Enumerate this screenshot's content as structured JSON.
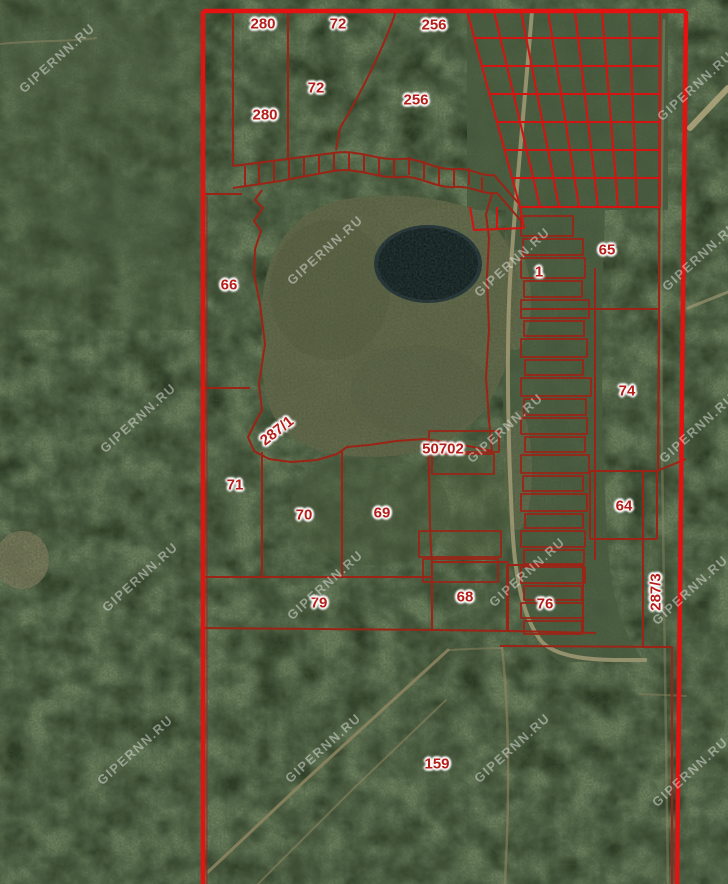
{
  "map": {
    "watermark_text": "GIPERNN.RU",
    "colors": {
      "outer_boundary": "#e41210",
      "grid_line": "#d51310",
      "parcel_line": "#9b2416",
      "label": "#b51d18",
      "watermark": "rgba(255,255,255,0.42)",
      "forest": "#26331f",
      "bog": "#6b6c4e",
      "lake": "#0c1522"
    },
    "parcel_labels": [
      {
        "text": "280",
        "x": 263,
        "y": 24,
        "rot": 0
      },
      {
        "text": "72",
        "x": 338,
        "y": 24,
        "rot": 0
      },
      {
        "text": "256",
        "x": 434,
        "y": 25,
        "rot": 0
      },
      {
        "text": "72",
        "x": 316,
        "y": 88,
        "rot": 0
      },
      {
        "text": "280",
        "x": 265,
        "y": 115,
        "rot": 0
      },
      {
        "text": "256",
        "x": 416,
        "y": 100,
        "rot": 0
      },
      {
        "text": "66",
        "x": 229,
        "y": 285,
        "rot": 0
      },
      {
        "text": "65",
        "x": 607,
        "y": 250,
        "rot": 0
      },
      {
        "text": "1",
        "x": 539,
        "y": 272,
        "rot": 0
      },
      {
        "text": "74",
        "x": 627,
        "y": 391,
        "rot": 0
      },
      {
        "text": "287/1",
        "x": 277,
        "y": 431,
        "rot": -38
      },
      {
        "text": "50702",
        "x": 443,
        "y": 449,
        "rot": 0
      },
      {
        "text": "71",
        "x": 235,
        "y": 485,
        "rot": 0
      },
      {
        "text": "70",
        "x": 304,
        "y": 515,
        "rot": 0
      },
      {
        "text": "69",
        "x": 382,
        "y": 513,
        "rot": 0
      },
      {
        "text": "64",
        "x": 624,
        "y": 506,
        "rot": 0
      },
      {
        "text": "79",
        "x": 319,
        "y": 603,
        "rot": 0
      },
      {
        "text": "68",
        "x": 465,
        "y": 597,
        "rot": 0
      },
      {
        "text": "76",
        "x": 545,
        "y": 604,
        "rot": 0
      },
      {
        "text": "287/3",
        "x": 656,
        "y": 592,
        "rot": -90
      },
      {
        "text": "159",
        "x": 437,
        "y": 764,
        "rot": 0
      }
    ],
    "watermarks": [
      {
        "x": 57,
        "y": 58
      },
      {
        "x": 695,
        "y": 86
      },
      {
        "x": 325,
        "y": 250
      },
      {
        "x": 512,
        "y": 262
      },
      {
        "x": 700,
        "y": 256
      },
      {
        "x": 138,
        "y": 418
      },
      {
        "x": 505,
        "y": 428
      },
      {
        "x": 697,
        "y": 428
      },
      {
        "x": 140,
        "y": 577
      },
      {
        "x": 325,
        "y": 585
      },
      {
        "x": 527,
        "y": 572
      },
      {
        "x": 690,
        "y": 590
      },
      {
        "x": 135,
        "y": 750
      },
      {
        "x": 323,
        "y": 748
      },
      {
        "x": 512,
        "y": 748
      },
      {
        "x": 690,
        "y": 772
      }
    ]
  }
}
